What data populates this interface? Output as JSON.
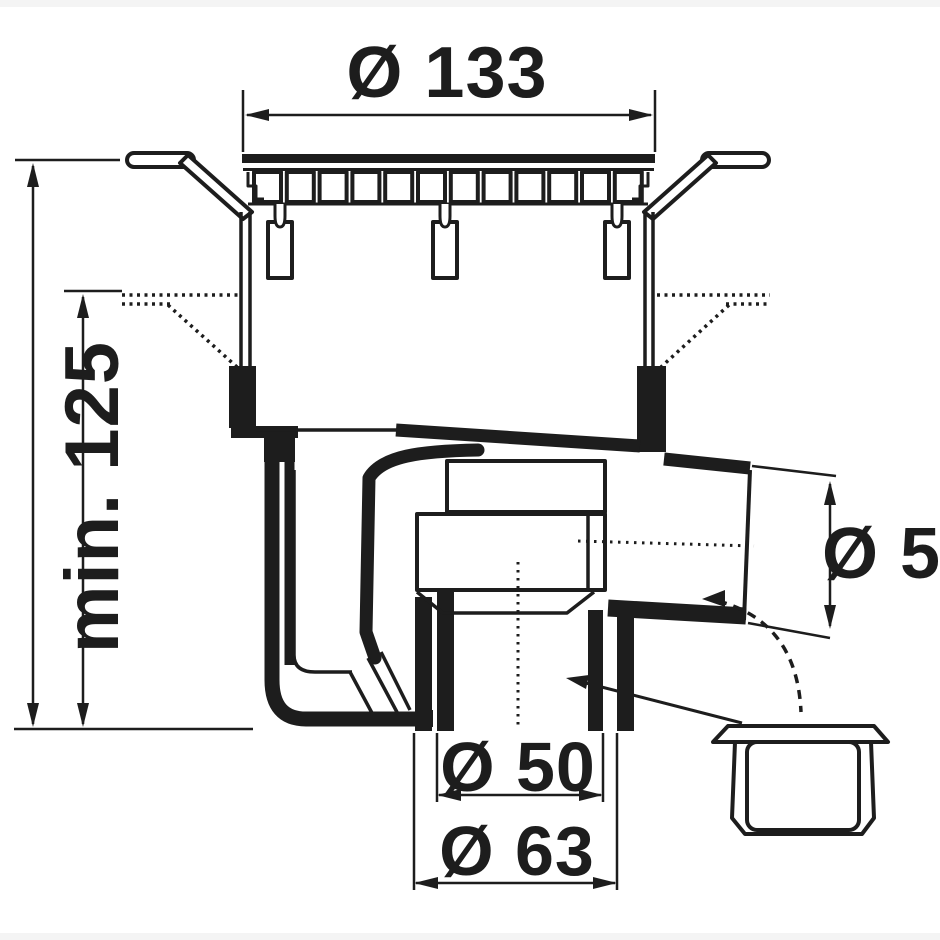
{
  "drawing": {
    "kind": "floor-drain-cross-section-technical-drawing",
    "dimensions": {
      "grate_diameter": "Ø 133",
      "height_max": "max. 175",
      "height_min": "min. 125",
      "side_outlet_diameter": "Ø 50",
      "bottom_outlet_inner_diameter": "Ø 50",
      "bottom_outlet_outer_diameter": "Ø 63"
    },
    "colors": {
      "line": "#1d1d1d",
      "background": "#ffffff",
      "edge_strip": "#f4f4f4"
    }
  }
}
